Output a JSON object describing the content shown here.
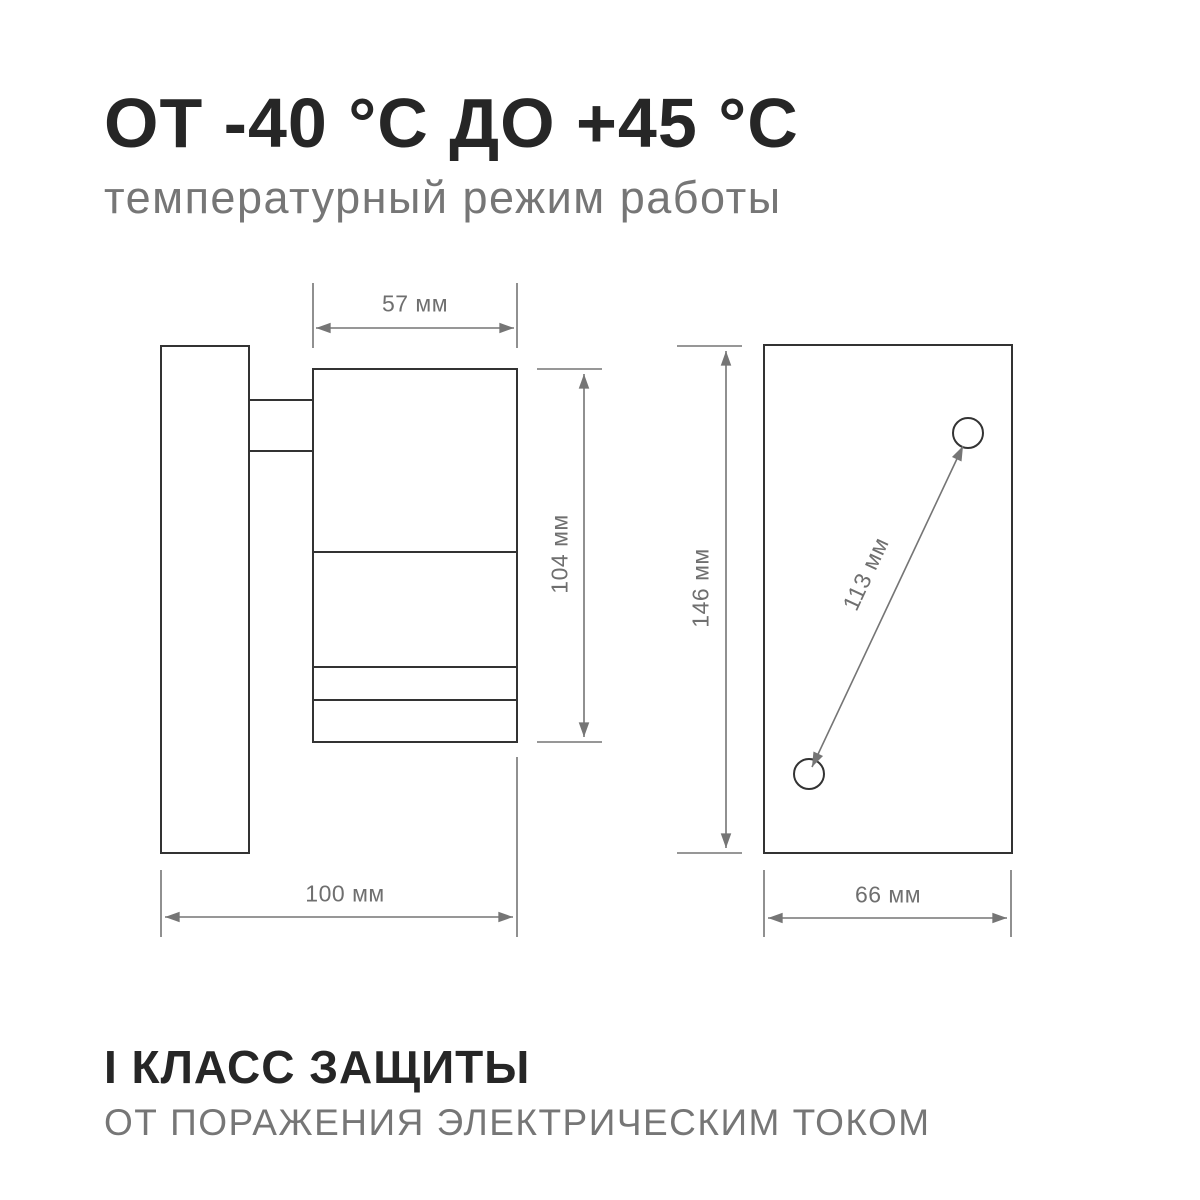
{
  "header": {
    "title": "ОТ -40 °С ДО +45 °С",
    "subtitle": "температурный режим работы"
  },
  "drawing": {
    "side_view": {
      "body_width_label": "57 мм",
      "body_height_label": "104 мм",
      "total_depth_label": "100 мм"
    },
    "back_view": {
      "plate_height_label": "146 мм",
      "plate_width_label": "66 мм",
      "hole_spacing_label": "113 мм"
    }
  },
  "footer": {
    "title": "I КЛАСС ЗАЩИТЫ",
    "subtitle": "ОТ ПОРАЖЕНИЯ ЭЛЕКТРИЧЕСКИМ ТОКОМ"
  },
  "colors": {
    "outline": "#333333",
    "dimension": "#757575",
    "label": "#6f6f6f",
    "title": "#262626",
    "muted": "#767676"
  }
}
